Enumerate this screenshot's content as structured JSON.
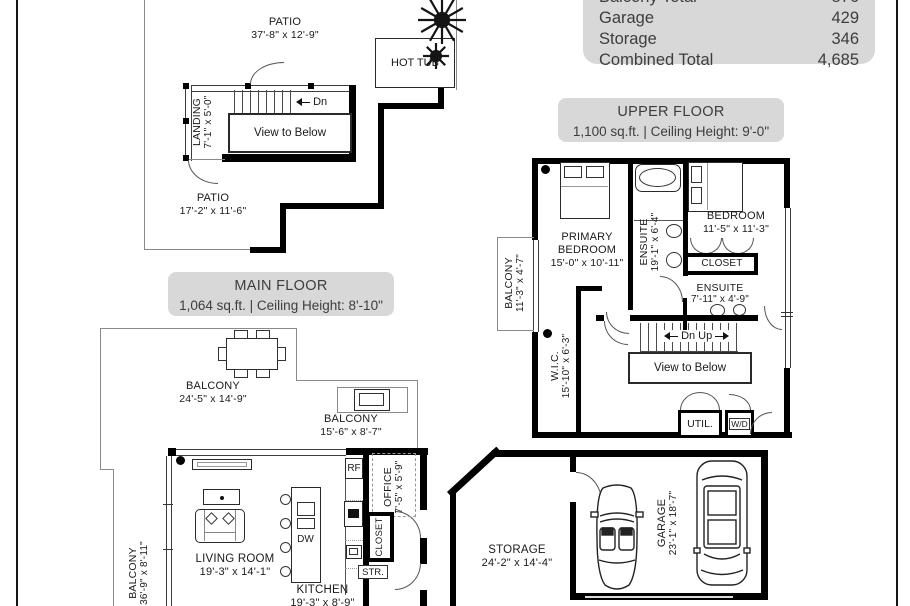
{
  "summary": {
    "rows": [
      {
        "label": "Balcony Total",
        "value": "876"
      },
      {
        "label": "Garage",
        "value": "429"
      },
      {
        "label": "Storage",
        "value": "346"
      },
      {
        "label": "Combined Total",
        "value": "4,685"
      }
    ]
  },
  "floors": {
    "upper": {
      "title": "UPPER FLOOR",
      "subtitle": "1,100 sq.ft. | Ceiling Height: 9'-0\""
    },
    "main": {
      "title": "MAIN FLOOR",
      "subtitle": "1,064 sq.ft. | Ceiling Height: 8'-10\""
    }
  },
  "rooms": {
    "patio_roof": {
      "name": "PATIO",
      "dims": "37'-8\" x 12'-9\""
    },
    "hot_tub": {
      "name": "HOT TUB"
    },
    "landing": {
      "name": "LANDING",
      "dims": "7'-1\" x 5'-0\""
    },
    "patio_lower": {
      "name": "PATIO",
      "dims": "17'-2\" x 11'-6\""
    },
    "balcony_upper": {
      "name": "BALCONY",
      "dims": "11'-3\" x 4'-7\""
    },
    "primary_bedroom": {
      "name1": "PRIMARY",
      "name2": "BEDROOM",
      "dims": "15'-0\" x 10'-11\""
    },
    "ensuite_primary": {
      "name": "ENSUITE",
      "dims": "19'-1\" x 6'-4\""
    },
    "bedroom": {
      "name": "BEDROOM",
      "dims": "11'-5\" x 11'-3\""
    },
    "closet_upper": {
      "name": "CLOSET"
    },
    "ensuite_second": {
      "name": "ENSUITE",
      "dims": "7'-11\" x 4'-9\""
    },
    "wic": {
      "name": "W.I.C.",
      "dims": "15'-10\" x 6'-3\""
    },
    "util": {
      "name": "UTIL."
    },
    "wd": {
      "name": "W/D"
    },
    "balcony_main": {
      "name": "BALCONY",
      "dims": "24'-5\" x 14'-9\""
    },
    "balcony_bbq": {
      "name": "BALCONY",
      "dims": "15'-6\" x 8'-7\""
    },
    "balcony_side": {
      "name": "BALCONY",
      "dims": "36'-9\" x 8'-11\""
    },
    "living_room": {
      "name": "LIVING ROOM",
      "dims": "19'-3\" x 14'-1\""
    },
    "kitchen": {
      "name": "KITCHEN",
      "dims": "19'-3\" x 8'-9\""
    },
    "office": {
      "name": "OFFICE",
      "dims": "7'-5\" x 5'-9\""
    },
    "closet_main": {
      "name": "CLOSET"
    },
    "storage": {
      "name": "STORAGE",
      "dims": "24'-2\" x 14'-4\""
    },
    "garage": {
      "name": "GARAGE",
      "dims": "23'-1\" x 18'-7\""
    }
  },
  "annotations": {
    "dn": "Dn",
    "dn_up": "Dn Up",
    "view_to_below": "View to Below",
    "rf": "RF",
    "dw": "DW",
    "str": "STR."
  },
  "colors": {
    "wall": "#000000",
    "thin_line": "#8a8a8a",
    "label_box_bg": "#d8d8d8",
    "label_text": "#3d3d3d"
  }
}
